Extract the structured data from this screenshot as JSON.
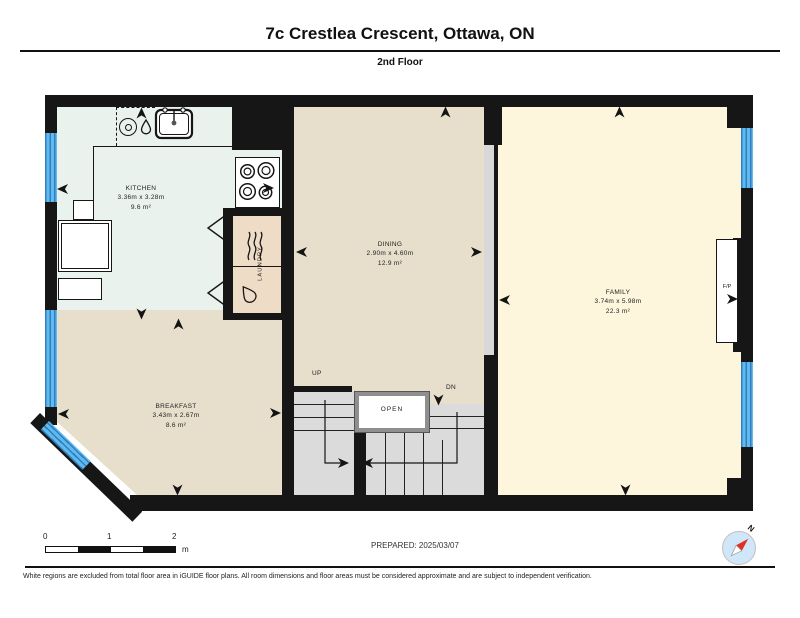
{
  "header": {
    "title": "7c Crestlea Crescent, Ottawa, ON",
    "subtitle": "2nd Floor"
  },
  "rooms": {
    "kitchen": {
      "name": "KITCHEN",
      "dims": "3.36m x 3.28m",
      "area": "9.6 m²"
    },
    "breakfast": {
      "name": "BREAKFAST",
      "dims": "3.43m x 2.67m",
      "area": "8.6 m²"
    },
    "dining": {
      "name": "DINING",
      "dims": "2.90m x 4.60m",
      "area": "12.9 m²"
    },
    "family": {
      "name": "FAMILY",
      "dims": "3.74m x 5.98m",
      "area": "22.3 m²"
    },
    "laundry": {
      "name": "LAUNDRY"
    }
  },
  "stairs": {
    "up_label": "UP",
    "dn_label": "DN",
    "open_label": "OPEN"
  },
  "fireplace": {
    "label": "F/P"
  },
  "scale_bar": {
    "tick0": "0",
    "tick1": "1",
    "tick2": "2",
    "unit": "m"
  },
  "prepared": {
    "text": "PREPARED: 2025/03/07"
  },
  "compass": {
    "n_label": "N"
  },
  "footer": {
    "disclaimer": "White regions are excluded from total floor area in iGUIDE floor plans. All room dimensions and floor areas must be considered approximate and are subject to independent verification."
  },
  "colors": {
    "wall": "#161616",
    "kitchen_floor": "#e9f2ec",
    "tan_floor": "#e7dfcc",
    "family_floor": "#fdf6dc",
    "laundry_box": "#eedcc6",
    "stairs": "#dbdbdb",
    "opening": "#d8d8d8",
    "window_blue": "#62b9ee",
    "compass_fill": "#cfe7f8",
    "needle_red": "#e03023"
  }
}
